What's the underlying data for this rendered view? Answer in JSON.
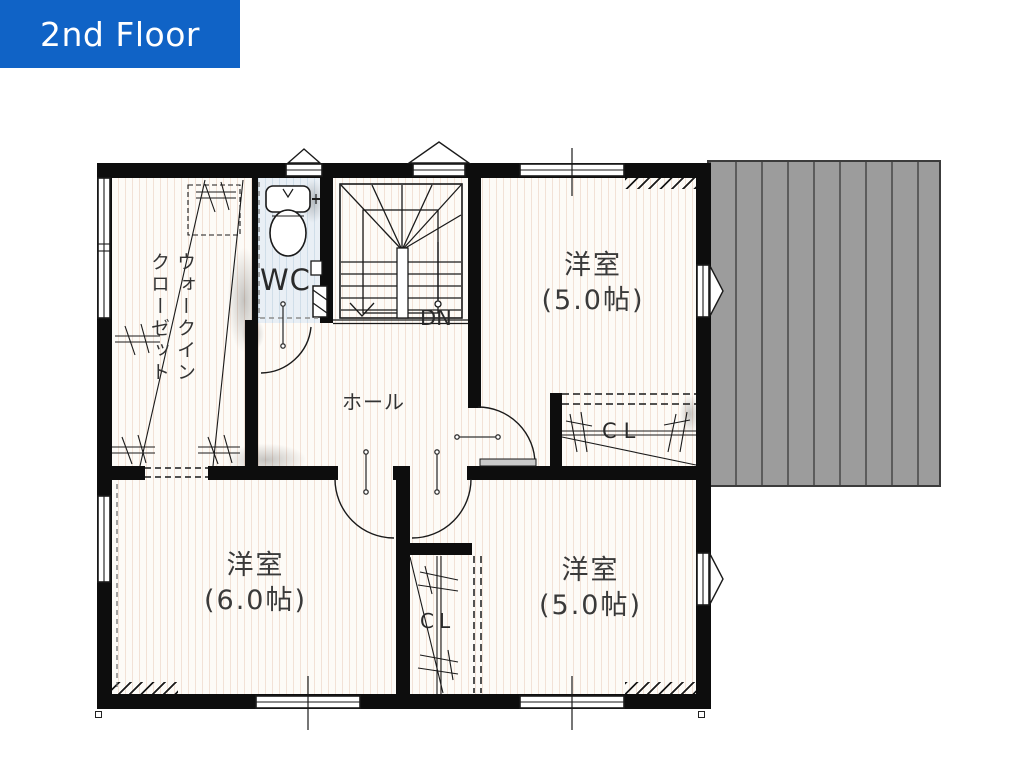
{
  "header": {
    "title": "2nd Floor"
  },
  "rooms": {
    "bedroom_top_right": {
      "name": "洋室",
      "size": "(5.0帖)"
    },
    "bedroom_bottom_left": {
      "name": "洋室",
      "size": "(6.0帖)"
    },
    "bedroom_bottom_right": {
      "name": "洋室",
      "size": "(5.0帖)"
    },
    "hall": {
      "name": "ホール"
    },
    "wc": {
      "name": "WC"
    },
    "walk_in_closet": {
      "line1": "ウォークイン",
      "line2": "クローゼット"
    },
    "closet_mid_right": {
      "name": "CL"
    },
    "closet_bottom": {
      "name": "CL"
    },
    "stairs": {
      "down": "DN"
    }
  },
  "colors": {
    "header_bg": "#1063c6",
    "header_text": "#ffffff",
    "wall": "#0d0d0d",
    "balcony_fill": "#9c9c9c",
    "wc_floor": "#e9eff5",
    "floor": "#fdfbf7"
  }
}
